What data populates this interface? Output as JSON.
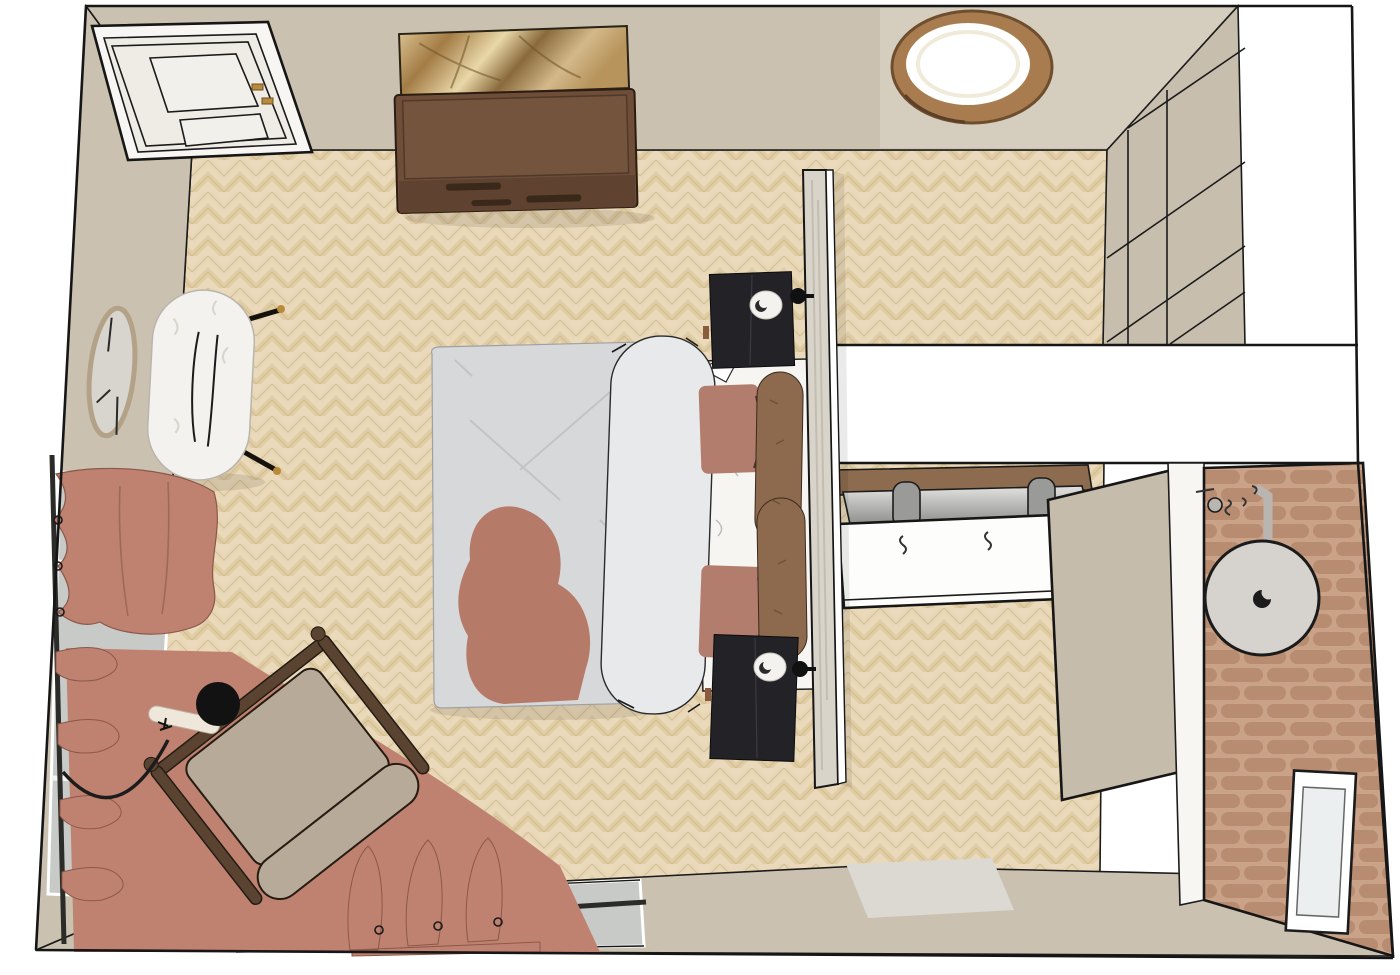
{
  "meta": {
    "title": "Top-down 3D rendering of a bedroom with en-suite shower room",
    "view": "bird's-eye axonometric interior render",
    "text_content": "none — image contains no readable text"
  },
  "palette": {
    "wall": "#cac1b1",
    "ceiling": "#d5cdbe",
    "wardrobe": "#c7beae",
    "floor_base": "#ead9ba",
    "floor_plank_a": "#e0cda4",
    "floor_plank_b": "#e8d7b4",
    "floor_line": "#cdb78f",
    "outline": "#1b1b1b",
    "duvet": "#d7d8da",
    "sheet": "#f6f5f2",
    "terracotta": "#b57b68",
    "pillow": "#b27d6c",
    "bolster": "#8d6a4d",
    "nightstand": "#232327",
    "headboard": "#d9d4c9",
    "curtain": "#c08270",
    "rug_patch": "#e6cfae",
    "chair_cushion": "#b7aa98",
    "chair_wood": "#5a4331",
    "dresser": "#6e4e39",
    "art_gold": "#c0a071",
    "light_ring_wood": "#a97c50",
    "light_glow": "#ffffff",
    "glass": "#c8cac8",
    "vanity_wood": "#8d6b4e",
    "counter_steel": "#c6c6c4",
    "sink": "#fdfdfc",
    "shower_head": "#d6d3cf",
    "tile_brick": "#b78c71",
    "tile_grout": "#c9a288",
    "panel": "#c6bcab",
    "mat": "#dcd9d3",
    "bench": "#f4f2ee",
    "mirror_face": "#d8d5ce",
    "mirror_frame": "#b3a288",
    "brass": "#b98a3c"
  },
  "scene": {
    "rooms": [
      {
        "name": "bedroom",
        "floor": "light oak herringbone parquet",
        "walls": "warm taupe"
      },
      {
        "name": "ensuite-shower",
        "wall_finish": "terracotta zellige tile"
      },
      {
        "name": "wardrobe-nook",
        "finish": "taupe panelled wardrobe"
      }
    ],
    "objects": [
      {
        "name": "entry-door",
        "label": "Panelled entry door (top-left)"
      },
      {
        "name": "dresser",
        "label": "Walnut dresser against top wall"
      },
      {
        "name": "wall-art",
        "label": "Gold abstract canvas above dresser"
      },
      {
        "name": "ceiling-light",
        "label": "Round wood-rimmed ceiling light"
      },
      {
        "name": "wardrobe",
        "label": "Built-in wardrobe, top-right"
      },
      {
        "name": "bed",
        "label": "Double bed with white duvet and terracotta throw"
      },
      {
        "name": "body-pillow",
        "label": "Long white body pillow"
      },
      {
        "name": "terracotta-pillows",
        "label": "Two terracotta pillows"
      },
      {
        "name": "bolster-cushions",
        "label": "Two brown bolster cushions"
      },
      {
        "name": "nightstand-top",
        "label": "Black nightstand (head, left)"
      },
      {
        "name": "nightstand-bottom",
        "label": "Black nightstand (head, right)"
      },
      {
        "name": "wall-sconce-top",
        "label": "Wall sconce on headboard wall"
      },
      {
        "name": "wall-sconce-bottom",
        "label": "Wall sconce on headboard wall"
      },
      {
        "name": "headboard-partition",
        "label": "Freestanding headboard partition wall"
      },
      {
        "name": "wall-mirror",
        "label": "Round wall mirror, left wall"
      },
      {
        "name": "boucle-bench",
        "label": "White boucle bench with black legs"
      },
      {
        "name": "corner-windows",
        "label": "Corner windows, left and bottom walls"
      },
      {
        "name": "curtains",
        "label": "Terracotta curtains on black rails"
      },
      {
        "name": "area-rug",
        "label": "Terracotta area rug"
      },
      {
        "name": "lounge-chair",
        "label": "Wood-frame lounge chair with beige cushions"
      },
      {
        "name": "floor-lamp",
        "label": "Black-shade arc floor lamp"
      },
      {
        "name": "vanity",
        "label": "Bathroom vanity with twin faucets"
      },
      {
        "name": "sliding-panel",
        "label": "Taupe sliding partition panel"
      },
      {
        "name": "shower-head",
        "label": "Round rain shower head"
      },
      {
        "name": "shower-niche",
        "label": "White shower niche / window"
      },
      {
        "name": "bath-mat",
        "label": "Light bath mat"
      }
    ]
  }
}
